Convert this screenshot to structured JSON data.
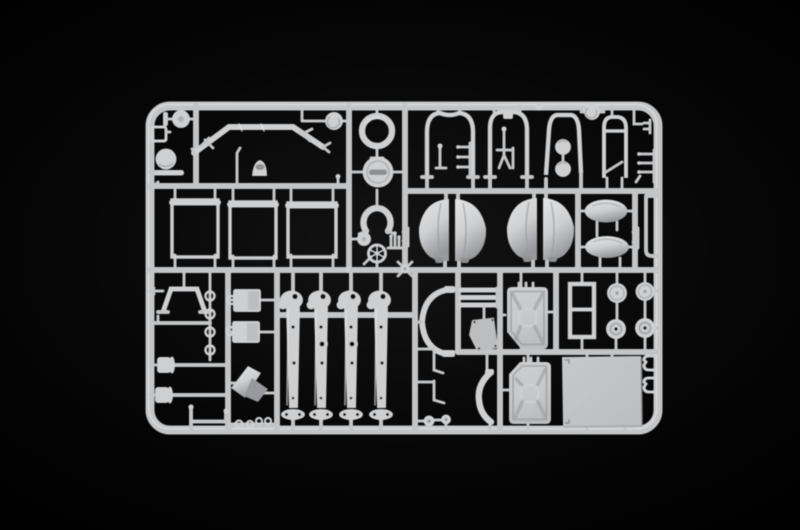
{
  "scene": {
    "description": "Photograph of a light grey injection-moulded plastic model kit sprue (parts tree) lying on a black background",
    "background_name": "black",
    "sprue_color_name": "light grey plastic"
  },
  "colors": {
    "background": "#000000",
    "plastic": "#c2c4c6",
    "plastic_light": "#cdcfd1",
    "plastic_hi": "#e3e5e6",
    "plastic_shadow": "#97999c",
    "panel": "#bbbdbf",
    "recess": "#8d8f92",
    "hole": "#0a0a0a"
  },
  "parts": [
    "outer-frame",
    "runner-grid",
    "wheel-disc",
    "storage-box-bracket",
    "drum-disc",
    "front-bumper-bar",
    "pulley-disc",
    "gear-lever",
    "seat-saddle",
    "window-frame-1",
    "window-frame-2",
    "window-frame-3",
    "spare-tyre-ring",
    "headlamp-cover-disc",
    "towing-horseshoe",
    "hub-cap-disc",
    "steering-wheel",
    "lever-cluster",
    "roll-bar-arch-1",
    "roll-bar-arch-2",
    "roll-bar-arch-3",
    "rung-bracket",
    "hook-pin",
    "a-frame-brace",
    "twin-lamps",
    "pulley-wheel",
    "fuel-tank-outline",
    "corner-pipes",
    "pin-bracket",
    "fender-shell-pair-1",
    "fender-shell-pair-2",
    "headlight-shell-upper",
    "headlight-shell-lower",
    "exhaust-pipe",
    "stand-bracket",
    "eyelet-chain",
    "tie-rod",
    "axle-hub-1",
    "axle-hub-2",
    "channel-bracket",
    "clevis-links",
    "engine-block-1",
    "engine-block-2",
    "funnel-horn",
    "fork-leg-1",
    "fork-leg-2",
    "fork-leg-3",
    "fork-leg-4",
    "windscreen-arc",
    "leaf-spring-stack",
    "seat-plate",
    "angle-rod-1",
    "angle-rod-2",
    "knob-caps",
    "mudguard-arc",
    "jerry-can-1",
    "jerry-can-2",
    "window-frame-4",
    "road-wheel-1",
    "road-wheel-2",
    "wheel-hub-1",
    "wheel-hub-2",
    "floor-panel",
    "latch-clip-1",
    "latch-clip-2"
  ]
}
